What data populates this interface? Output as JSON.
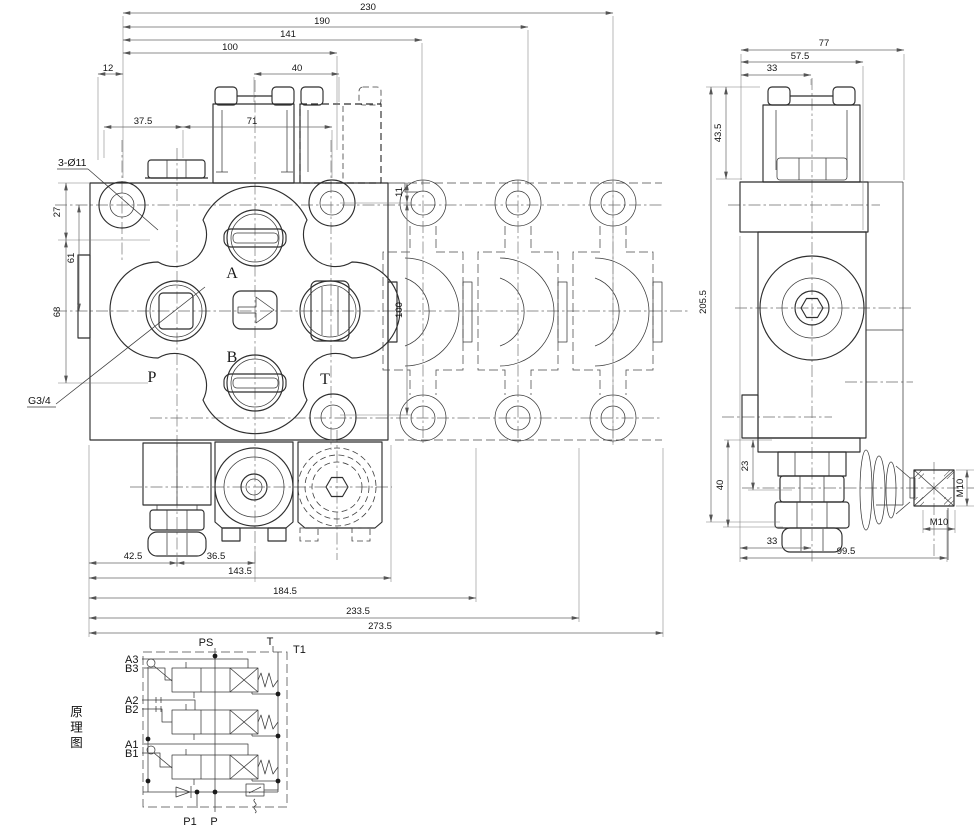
{
  "drawing": {
    "front": {
      "dims": {
        "w230": "230",
        "w190": "190",
        "w141": "141",
        "w100": "100",
        "w40": "40",
        "w12": "12",
        "w37_5": "37.5",
        "w71": "71",
        "h27": "27",
        "h61": "61",
        "h68": "68",
        "r11": "11",
        "r100": "100",
        "b42_5": "42.5",
        "b36_5": "36.5",
        "b143_5": "143.5",
        "b184_5": "184.5",
        "b233_5": "233.5",
        "b273_5": "273.5"
      },
      "callouts": {
        "holes": "3-Ø11",
        "thread": "G3/4"
      },
      "ports": {
        "a": "A",
        "b": "B",
        "p": "P",
        "t": "T"
      }
    },
    "side": {
      "dims": {
        "w77": "77",
        "w57_5": "57.5",
        "w33": "33",
        "h43_5": "43.5",
        "h205_5": "205.5",
        "h23": "23",
        "h40": "40",
        "b33": "33",
        "b99_5": "99.5"
      },
      "callouts": {
        "m10_side": "M10",
        "m10_bottom": "M10"
      }
    },
    "schematic": {
      "caption": "原理图",
      "labels": {
        "ps": "PS",
        "t": "T",
        "t1": "T1",
        "a3": "A3",
        "b3": "B3",
        "a2": "A2",
        "b2": "B2",
        "a1": "A1",
        "b1": "B1",
        "p1": "P1",
        "p": "P"
      }
    }
  }
}
